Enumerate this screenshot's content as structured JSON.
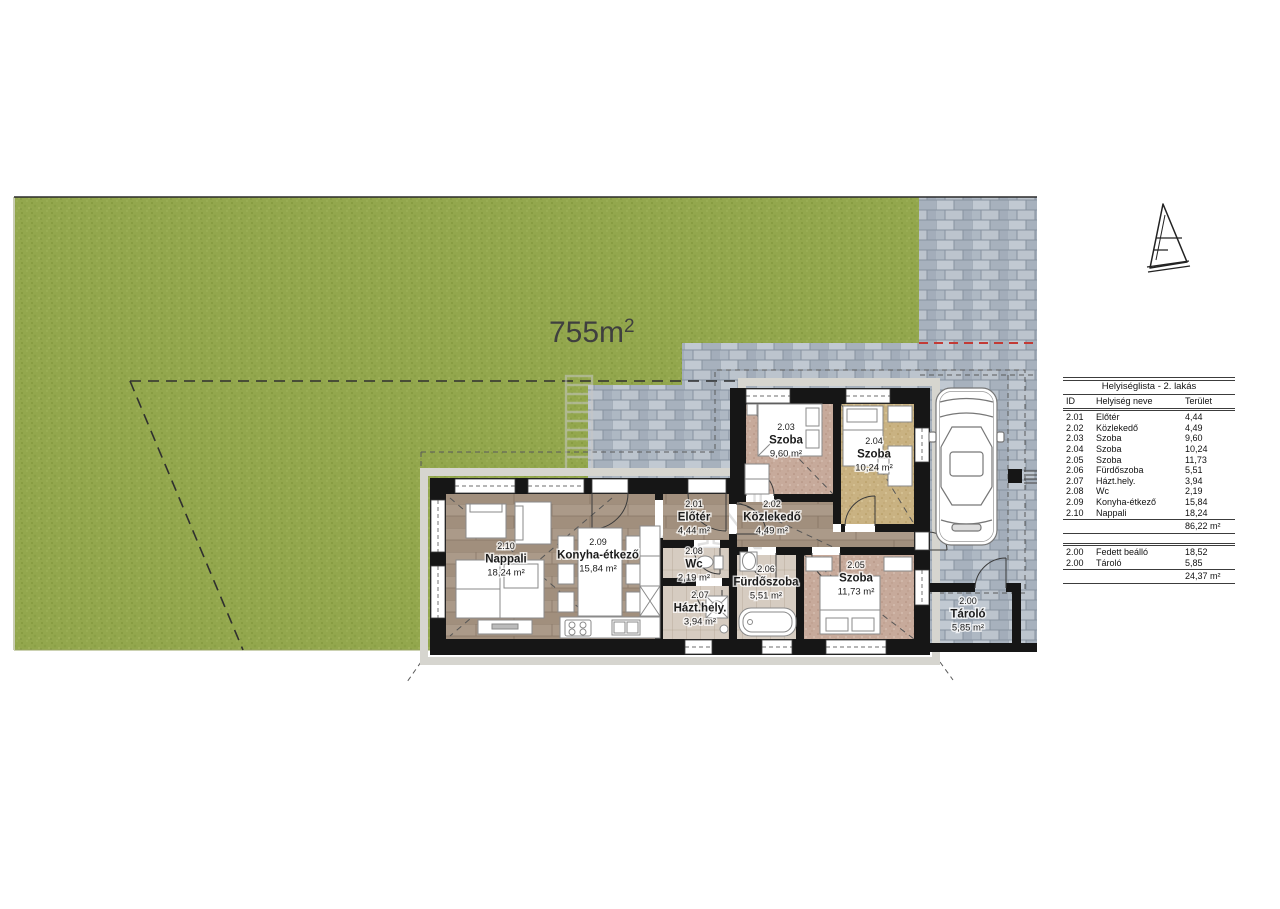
{
  "site": {
    "area_value": "755m",
    "area_superscript": "2",
    "colors": {
      "lawn": "#93a74d",
      "paver": "#b3bcc7",
      "wall": "#161616",
      "red_boundary": "#c23b36",
      "wood_floor": "#a79584",
      "bedroom_floor_pink": "#c7aa9b",
      "bedroom_floor_tan": "#c9b282",
      "wet_room_floor": "#d6ccc1"
    }
  },
  "icons": {
    "north_arrow": "north-arrow-icon",
    "car": "car-top-view-icon",
    "watermark_ladder": "ladder-logo-icon"
  },
  "watermark": {
    "text": "GDN"
  },
  "floor_plan": {
    "labels": [
      {
        "key": "eloter",
        "id": "2.01",
        "name": "Előtér",
        "area": "4,44 m²",
        "x": 694,
        "y": 507
      },
      {
        "key": "kozlekedo",
        "id": "2.02",
        "name": "Közlekedő",
        "area": "4,49 m²",
        "x": 772,
        "y": 507
      },
      {
        "key": "szoba-203",
        "id": "2.03",
        "name": "Szoba",
        "area": "9,60 m²",
        "x": 786,
        "y": 430
      },
      {
        "key": "szoba-204",
        "id": "2.04",
        "name": "Szoba",
        "area": "10,24 m²",
        "x": 874,
        "y": 444
      },
      {
        "key": "szoba-205",
        "id": "2.05",
        "name": "Szoba",
        "area": "11,73 m²",
        "x": 856,
        "y": 568
      },
      {
        "key": "furdoszoba",
        "id": "2.06",
        "name": "Fürdőszoba",
        "area": "5,51 m²",
        "x": 766,
        "y": 572
      },
      {
        "key": "hazthely",
        "id": "2.07",
        "name": "Házt.hely.",
        "area": "3,94 m²",
        "x": 700,
        "y": 598
      },
      {
        "key": "wc",
        "id": "2.08",
        "name": "Wc",
        "area": "2,19 m²",
        "x": 694,
        "y": 554
      },
      {
        "key": "konyha",
        "id": "2.09",
        "name": "Konyha-étkező",
        "area": "15,84 m²",
        "x": 598,
        "y": 545
      },
      {
        "key": "nappali",
        "id": "2.10",
        "name": "Nappali",
        "area": "18,24 m²",
        "x": 506,
        "y": 549
      },
      {
        "key": "tarolo",
        "id": "2.00",
        "name": "Tároló",
        "area": "5,85 m²",
        "x": 968,
        "y": 604
      }
    ]
  },
  "room_table": {
    "title": "Helyiséglista - 2. lakás",
    "headers": {
      "id": "ID",
      "name": "Helyiség neve",
      "area": "Terület"
    },
    "rows": [
      {
        "id": "2.01",
        "name": "Előtér",
        "area": "4,44"
      },
      {
        "id": "2.02",
        "name": "Közlekedő",
        "area": "4,49"
      },
      {
        "id": "2.03",
        "name": "Szoba",
        "area": "9,60"
      },
      {
        "id": "2.04",
        "name": "Szoba",
        "area": "10,24"
      },
      {
        "id": "2.05",
        "name": "Szoba",
        "area": "11,73"
      },
      {
        "id": "2.06",
        "name": "Fürdőszoba",
        "area": "5,51"
      },
      {
        "id": "2.07",
        "name": "Házt.hely.",
        "area": "3,94"
      },
      {
        "id": "2.08",
        "name": "Wc",
        "area": "2,19"
      },
      {
        "id": "2.09",
        "name": "Konyha-étkező",
        "area": "15,84"
      },
      {
        "id": "2.10",
        "name": "Nappali",
        "area": "18,24"
      }
    ],
    "total": "86,22 m²",
    "outdoor_rows": [
      {
        "id": "2.00",
        "name": "Fedett beálló",
        "area": "18,52"
      },
      {
        "id": "2.00",
        "name": "Tároló",
        "area": "5,85"
      }
    ],
    "outdoor_total": "24,37 m²"
  }
}
